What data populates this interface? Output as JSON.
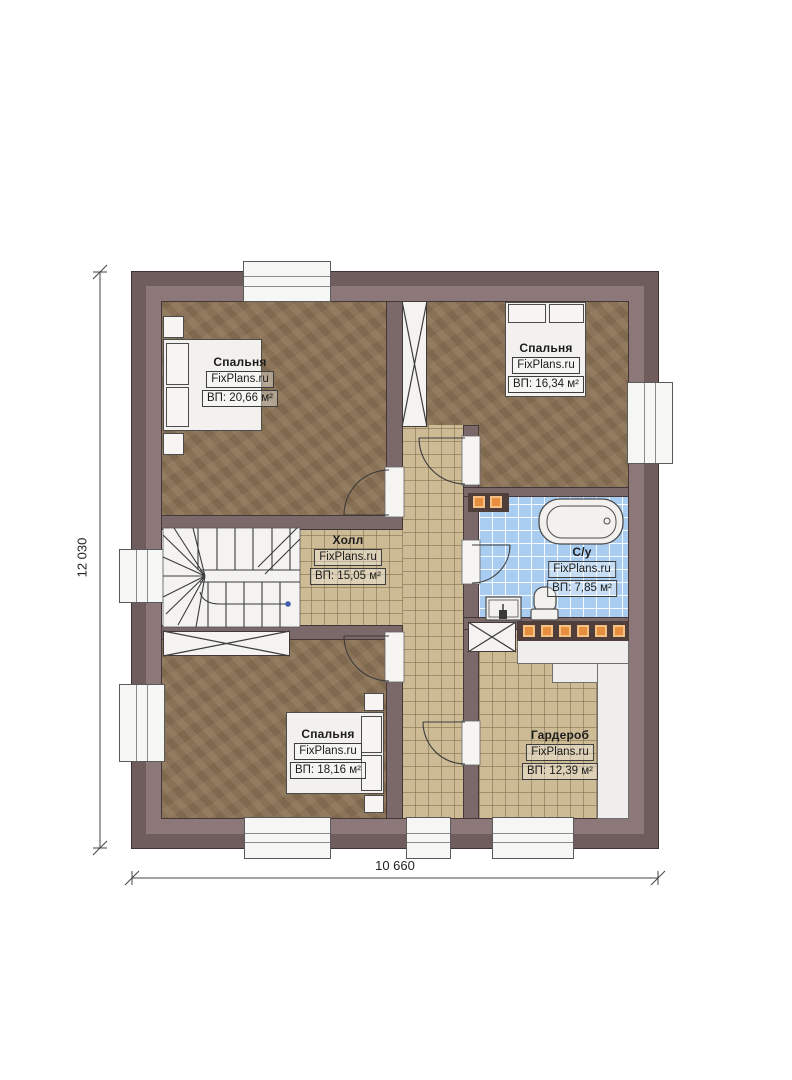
{
  "page": {
    "type": "floor-plan"
  },
  "brand": "FixPlans.ru",
  "dimensions": {
    "width_total": "10 660",
    "height_total": "12 030"
  },
  "rooms": {
    "bedroom_tl": {
      "name": "Спальня",
      "brand": "FixPlans.ru",
      "area": "ВП: 20,66 м²"
    },
    "bedroom_tr": {
      "name": "Спальня",
      "brand": "FixPlans.ru",
      "area": "ВП: 16,34 м²"
    },
    "hall": {
      "name": "Холл",
      "brand": "FixPlans.ru",
      "area": "ВП: 15,05 м²"
    },
    "bathroom": {
      "name": "С/у",
      "brand": "FixPlans.ru",
      "area": "ВП: 7,85 м²"
    },
    "bedroom_bl": {
      "name": "Спальня",
      "brand": "FixPlans.ru",
      "area": "ВП: 18,16 м²"
    },
    "wardrobe": {
      "name": "Гардероб",
      "brand": "FixPlans.ru",
      "area": "ВП: 12,39 м²"
    }
  },
  "colors": {
    "wall_outer": "#6f5d5e",
    "wall_inner": "#8c7879",
    "wood_floor": "#8b7355",
    "tile_floor": "#cdbb96",
    "bath_tile": "#a9cdf0",
    "accent_orange": "#e78f3f"
  }
}
